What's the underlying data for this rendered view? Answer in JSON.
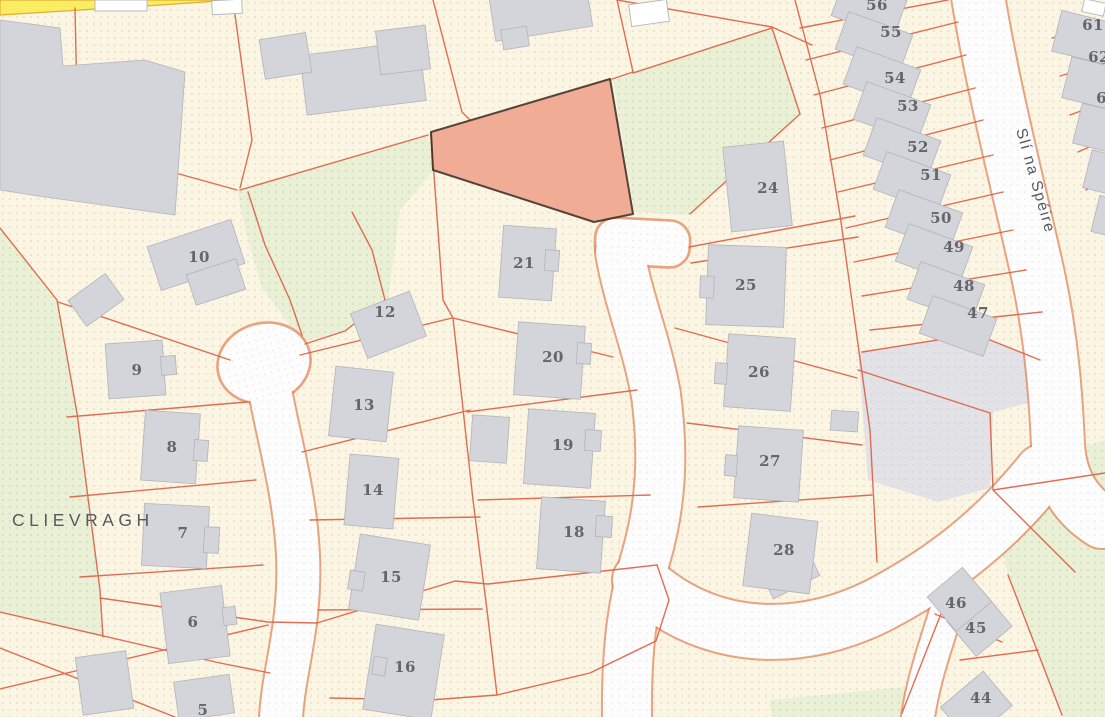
{
  "map": {
    "townland_label": "CLIEVRAGH",
    "street_label": "Slí na Spéire",
    "highlighted_plot": {
      "points": "431,132 610,79 633,214 594,222 433,170"
    },
    "colors": {
      "parcel_fill": "#fbf5e3",
      "parcel_dot": "#e9bd99",
      "green_fill": "#e9f0d5",
      "green_dot": "#b7cba6",
      "road_fill": "#fdfdfe",
      "road_dot": "#dcdce6",
      "boundary_line": "#dd6247",
      "road_casing": "#e2875f",
      "building_fill": "#d4d5da",
      "building_stroke": "#b3b4bc",
      "parking_fill": "#e2e2e7",
      "parking_dot": "#c9c9d3",
      "yellow_road_fill": "#f9ee63",
      "yellow_road_casing": "#dfae33",
      "highlight_fill": "#f0a28c",
      "highlight_outline": "#3f2c22",
      "label_color": "#64666c",
      "place_label_color": "#565a60"
    },
    "plot_numbers": [
      {
        "t": "5",
        "x": 203,
        "y": 710
      },
      {
        "t": "6",
        "x": 193,
        "y": 622
      },
      {
        "t": "7",
        "x": 183,
        "y": 533
      },
      {
        "t": "8",
        "x": 172,
        "y": 447
      },
      {
        "t": "9",
        "x": 137,
        "y": 370
      },
      {
        "t": "10",
        "x": 199,
        "y": 257
      },
      {
        "t": "12",
        "x": 385,
        "y": 312
      },
      {
        "t": "13",
        "x": 364,
        "y": 405
      },
      {
        "t": "14",
        "x": 373,
        "y": 490
      },
      {
        "t": "15",
        "x": 391,
        "y": 577
      },
      {
        "t": "16",
        "x": 405,
        "y": 667
      },
      {
        "t": "18",
        "x": 574,
        "y": 532
      },
      {
        "t": "19",
        "x": 563,
        "y": 445
      },
      {
        "t": "20",
        "x": 553,
        "y": 357
      },
      {
        "t": "21",
        "x": 524,
        "y": 263
      },
      {
        "t": "24",
        "x": 768,
        "y": 188
      },
      {
        "t": "25",
        "x": 746,
        "y": 285
      },
      {
        "t": "26",
        "x": 759,
        "y": 372
      },
      {
        "t": "27",
        "x": 770,
        "y": 461
      },
      {
        "t": "28",
        "x": 784,
        "y": 550
      },
      {
        "t": "44",
        "x": 981,
        "y": 698
      },
      {
        "t": "45",
        "x": 976,
        "y": 628
      },
      {
        "t": "46",
        "x": 956,
        "y": 603
      },
      {
        "t": "47",
        "x": 978,
        "y": 313
      },
      {
        "t": "48",
        "x": 964,
        "y": 286
      },
      {
        "t": "49",
        "x": 954,
        "y": 247
      },
      {
        "t": "50",
        "x": 941,
        "y": 218
      },
      {
        "t": "51",
        "x": 931,
        "y": 175
      },
      {
        "t": "52",
        "x": 918,
        "y": 147
      },
      {
        "t": "53",
        "x": 908,
        "y": 106
      },
      {
        "t": "54",
        "x": 895,
        "y": 78
      },
      {
        "t": "55",
        "x": 891,
        "y": 32
      },
      {
        "t": "56",
        "x": 877,
        "y": 5
      },
      {
        "t": "61",
        "x": 1093,
        "y": 25
      },
      {
        "t": "62",
        "x": 1099,
        "y": 57
      },
      {
        "t": "63",
        "x": 1107,
        "y": 98
      }
    ]
  }
}
